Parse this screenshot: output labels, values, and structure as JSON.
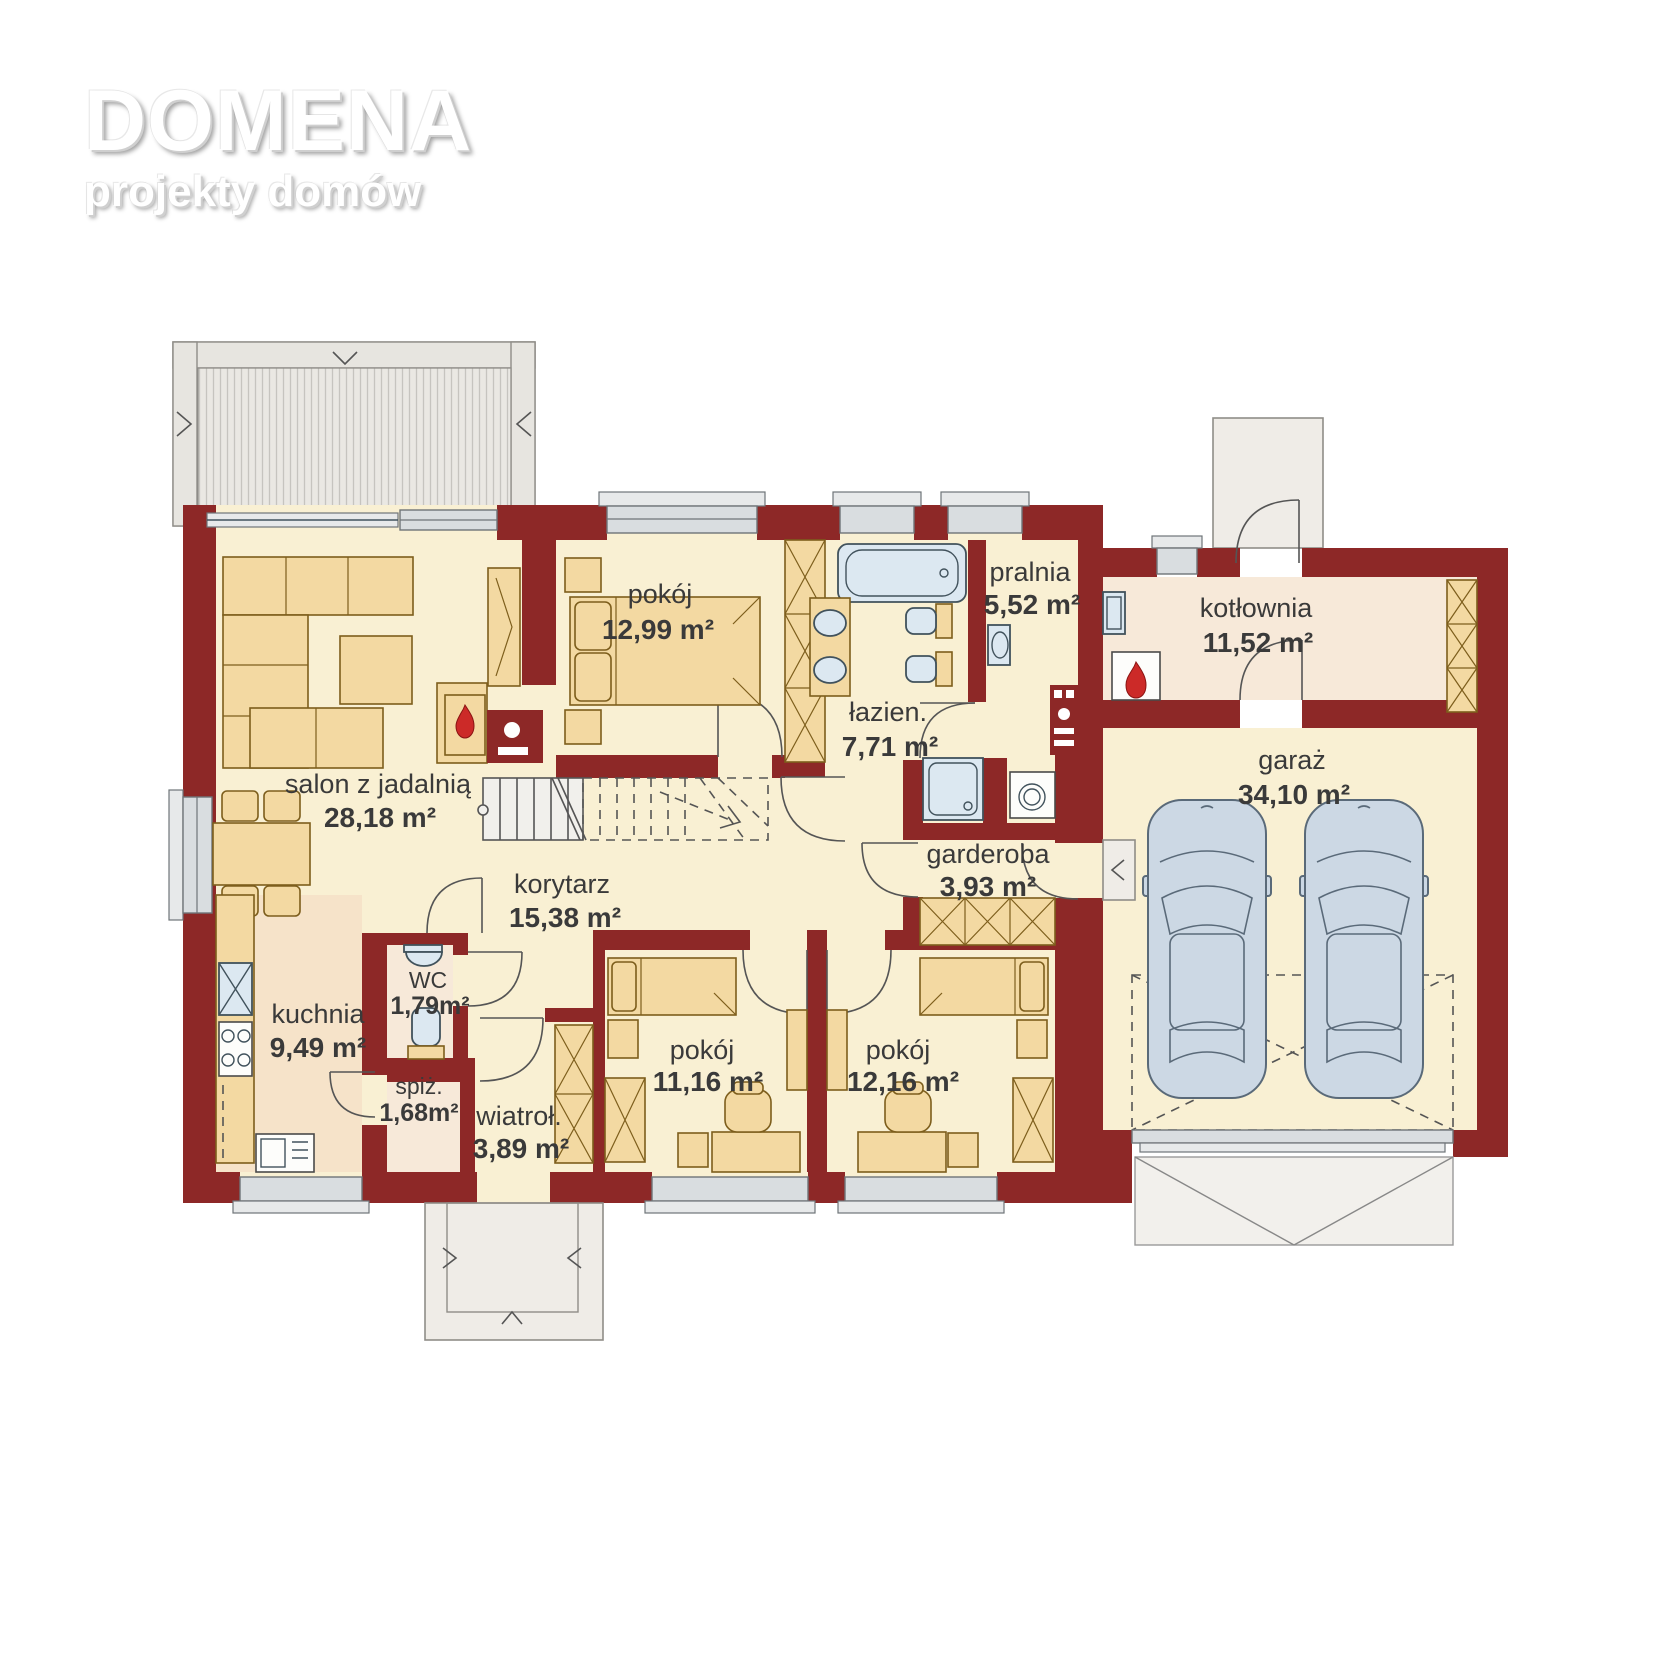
{
  "logo": {
    "title": "DOMENA",
    "subtitle": "projekty domów"
  },
  "colors": {
    "wall": "#8d2827",
    "floor_cream": "#f9f0d3",
    "floor_kitchen": "#f6e3c9",
    "floor_utility": "#f7e9d9",
    "furniture_tan": "#f3d9a2",
    "fixture_blue": "#dce8f1",
    "flame_red": "#cc2a28",
    "terrace_gray": "#e7e5e0",
    "label_text": "#3a3a3a"
  },
  "rooms": [
    {
      "id": "salon",
      "name": "salon z jadalnią",
      "area": "28,18 m²"
    },
    {
      "id": "pokoj1",
      "name": "pokój",
      "area": "12,99 m²"
    },
    {
      "id": "lazienka",
      "name": "łazien.",
      "area": "7,71 m²"
    },
    {
      "id": "pralnia",
      "name": "pralnia",
      "area": "5,52 m²"
    },
    {
      "id": "kotlownia",
      "name": "kotłownia",
      "area": "11,52 m²"
    },
    {
      "id": "garaz",
      "name": "garaż",
      "area": "34,10 m²"
    },
    {
      "id": "garderoba",
      "name": "garderoba",
      "area": "3,93 m²"
    },
    {
      "id": "korytarz",
      "name": "korytarz",
      "area": "15,38 m²"
    },
    {
      "id": "kuchnia",
      "name": "kuchnia",
      "area": "9,49 m²"
    },
    {
      "id": "wc",
      "name": "WC",
      "area": "1,79m²"
    },
    {
      "id": "spiz",
      "name": "spiż.",
      "area": "1,68m²"
    },
    {
      "id": "wiatrolap",
      "name": "wiatroł.",
      "area": "3,89 m²"
    },
    {
      "id": "pokoj2",
      "name": "pokój",
      "area": "11,16 m²"
    },
    {
      "id": "pokoj3",
      "name": "pokój",
      "area": "12,16 m²"
    }
  ]
}
